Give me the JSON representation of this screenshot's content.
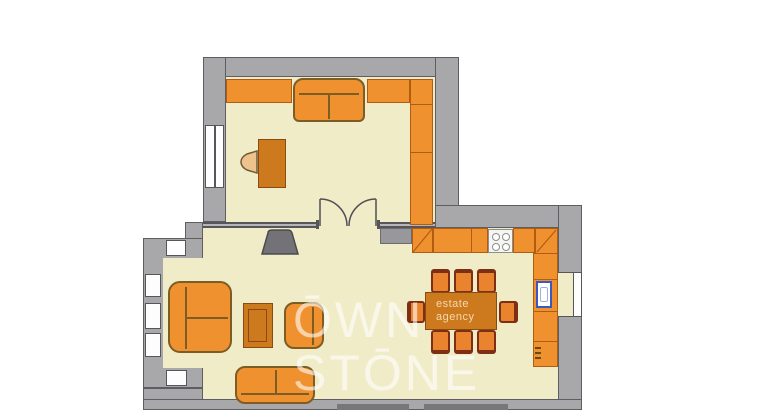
{
  "watermark": {
    "line1": "ŌWN",
    "line2": "STŌNE"
  },
  "table_watermark": {
    "line1": "estate",
    "line2": "agency"
  },
  "palette": {
    "background": "#ffffff",
    "wall": "#a8a8ab",
    "walledge": "#5d5d62",
    "floor": "#f1ecc8",
    "orange": "#f0912f",
    "orangedark": "#cd7a1e",
    "outline": "#b05d12",
    "sofaline": "#7c5d26",
    "chairline": "#7d2f16",
    "blue": "#3a57c2",
    "tvgray": "#737377",
    "watermarkcolor": "rgba(255,255,255,0.6)",
    "tablewmcolor": "rgba(255,238,210,0.8)"
  }
}
